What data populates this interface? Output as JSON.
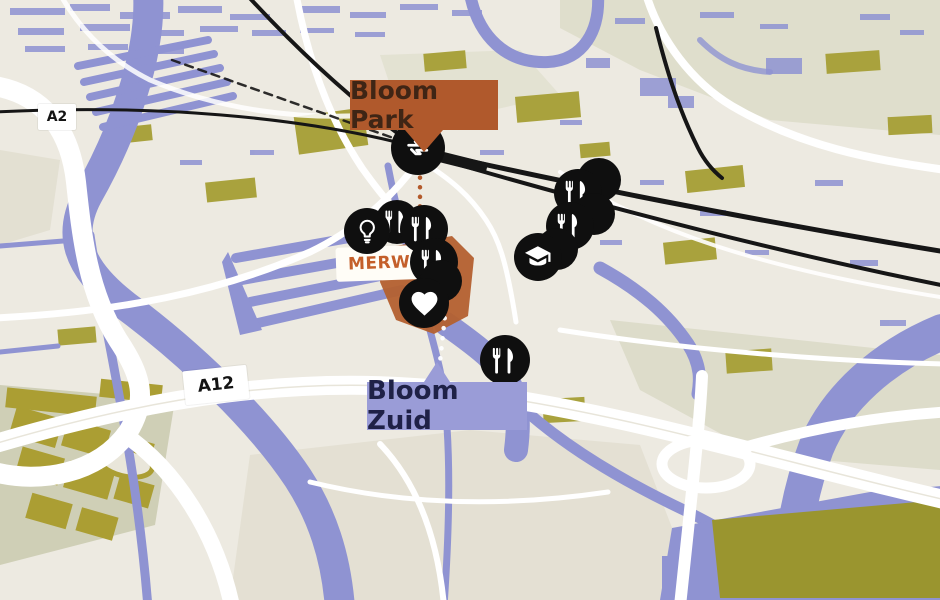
{
  "map": {
    "colors": {
      "land": "#edeae1",
      "water": "#8f93d2",
      "olive": "#a9a23d",
      "mustard": "#ab9e33",
      "sage": "#d6d6c1",
      "road": "#ffffff",
      "railway": "#161616",
      "marker_bg": "#0f0f0f",
      "marker_icon": "#ffffff",
      "district_fill": "#b4602f"
    },
    "region_labels": {
      "bloom_park": {
        "text": "Bloom Park",
        "bg": "#b0592c",
        "fg": "#3f2515"
      },
      "bloom_zuid": {
        "text": "Bloom Zuid",
        "bg": "#9a9cd7",
        "fg": "#1f2147"
      },
      "merwede": {
        "text": "MERW",
        "fg": "#c45f2a"
      }
    },
    "road_badges": [
      {
        "id": "a2",
        "text": "A2"
      },
      {
        "id": "a12",
        "text": "A12"
      }
    ],
    "connectors": [
      {
        "id": "bloom-park-connector",
        "color": "#b35a2b"
      },
      {
        "id": "bloom-zuid-connector",
        "color": "#ffffff"
      }
    ],
    "markers": [
      {
        "icon": "restaurant",
        "x": 397,
        "y": 222,
        "d": 44
      },
      {
        "icon": "lightbulb",
        "x": 367,
        "y": 231,
        "d": 46
      },
      {
        "icon": "restaurant",
        "x": 424,
        "y": 229,
        "d": 48
      },
      {
        "icon": "restaurant",
        "x": 434,
        "y": 262,
        "d": 48
      },
      {
        "icon": "none",
        "x": 441,
        "y": 281,
        "d": 42
      },
      {
        "icon": "heart",
        "x": 424,
        "y": 303,
        "d": 50
      },
      {
        "icon": "none",
        "x": 599,
        "y": 180,
        "d": 44
      },
      {
        "icon": "restaurant",
        "x": 578,
        "y": 193,
        "d": 48
      },
      {
        "icon": "none",
        "x": 594,
        "y": 214,
        "d": 42
      },
      {
        "icon": "restaurant",
        "x": 570,
        "y": 226,
        "d": 48
      },
      {
        "icon": "none",
        "x": 557,
        "y": 249,
        "d": 42
      },
      {
        "icon": "education",
        "x": 538,
        "y": 257,
        "d": 48
      },
      {
        "icon": "train",
        "x": 418,
        "y": 148,
        "d": 54
      },
      {
        "icon": "restaurant",
        "x": 505,
        "y": 360,
        "d": 50
      }
    ]
  }
}
